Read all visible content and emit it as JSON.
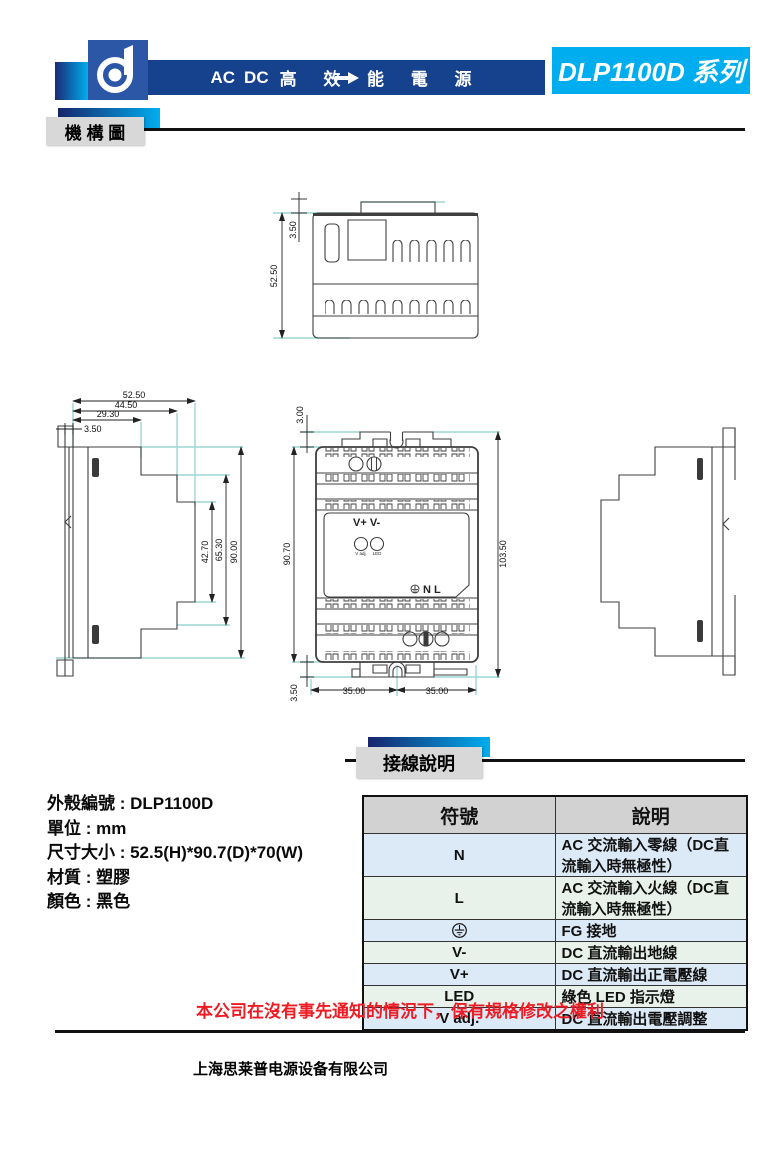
{
  "colors": {
    "header_blue": "#16418c",
    "accent_cyan": "#00aeef",
    "logo_blue": "#2c57a7",
    "section_gray": "#d8d8d8",
    "table_header_gray": "#d2d2d2",
    "row_blue": "#dce9f6",
    "row_green": "#e8f2ea",
    "notice_red": "#ed1c24",
    "extension_line_teal": "#9bd6d2"
  },
  "header": {
    "title_ac": "AC",
    "title_dc": "DC",
    "title_cjk": "高 效 能 電 源",
    "series_badge": "DLP1100D 系列"
  },
  "sections": {
    "mechanical": "機 構 圖",
    "wiring": "接線說明"
  },
  "top_view": {
    "dim_tab": "3.50",
    "dim_height": "52.50"
  },
  "side_view": {
    "dim_52": "52.50",
    "dim_44": "44.50",
    "dim_29": "29.30",
    "dim_3": "3.50",
    "dim_42": "42.70",
    "dim_65": "65.30",
    "dim_90": "90.00"
  },
  "front_view": {
    "dim_top": "3.00",
    "dim_body": "90.70",
    "dim_total": "103.50",
    "dim_bottom": "3.50",
    "dim_w_left": "35.00",
    "dim_w_right": "35.00",
    "label_output": "V+ V-",
    "label_vadj": "V adj.",
    "label_led": "LED",
    "label_input": "N L"
  },
  "product_info": {
    "lines": [
      "外殼編號  : DLP1100D",
      "單位 : mm",
      "尺寸大小 : 52.5(H)*90.7(D)*70(W)",
      "材質 : 塑膠",
      "顏色 : 黑色"
    ]
  },
  "wiring_table": {
    "headers": [
      "符號",
      "說明"
    ],
    "rows": [
      {
        "symbol": "N",
        "description": "AC 交流輸入零線（DC直流輸入時無極性）"
      },
      {
        "symbol": "L",
        "description": "AC 交流輸入火線（DC直流輸入時無極性）"
      },
      {
        "symbol_icon": "earth-ground-icon",
        "description": "FG 接地"
      },
      {
        "symbol": "V-",
        "description": "DC 直流輸出地線"
      },
      {
        "symbol": "V+",
        "description": "DC 直流輸出正電壓線"
      },
      {
        "symbol": "LED",
        "description": "綠色 LED 指示燈"
      },
      {
        "symbol": "V adj.",
        "description": "DC 直流輸出電壓調整"
      }
    ]
  },
  "footer": {
    "notice": "本公司在沒有事先通知的情況下，保有規格修改之權利",
    "company": "上海思莱普电源设备有限公司"
  }
}
